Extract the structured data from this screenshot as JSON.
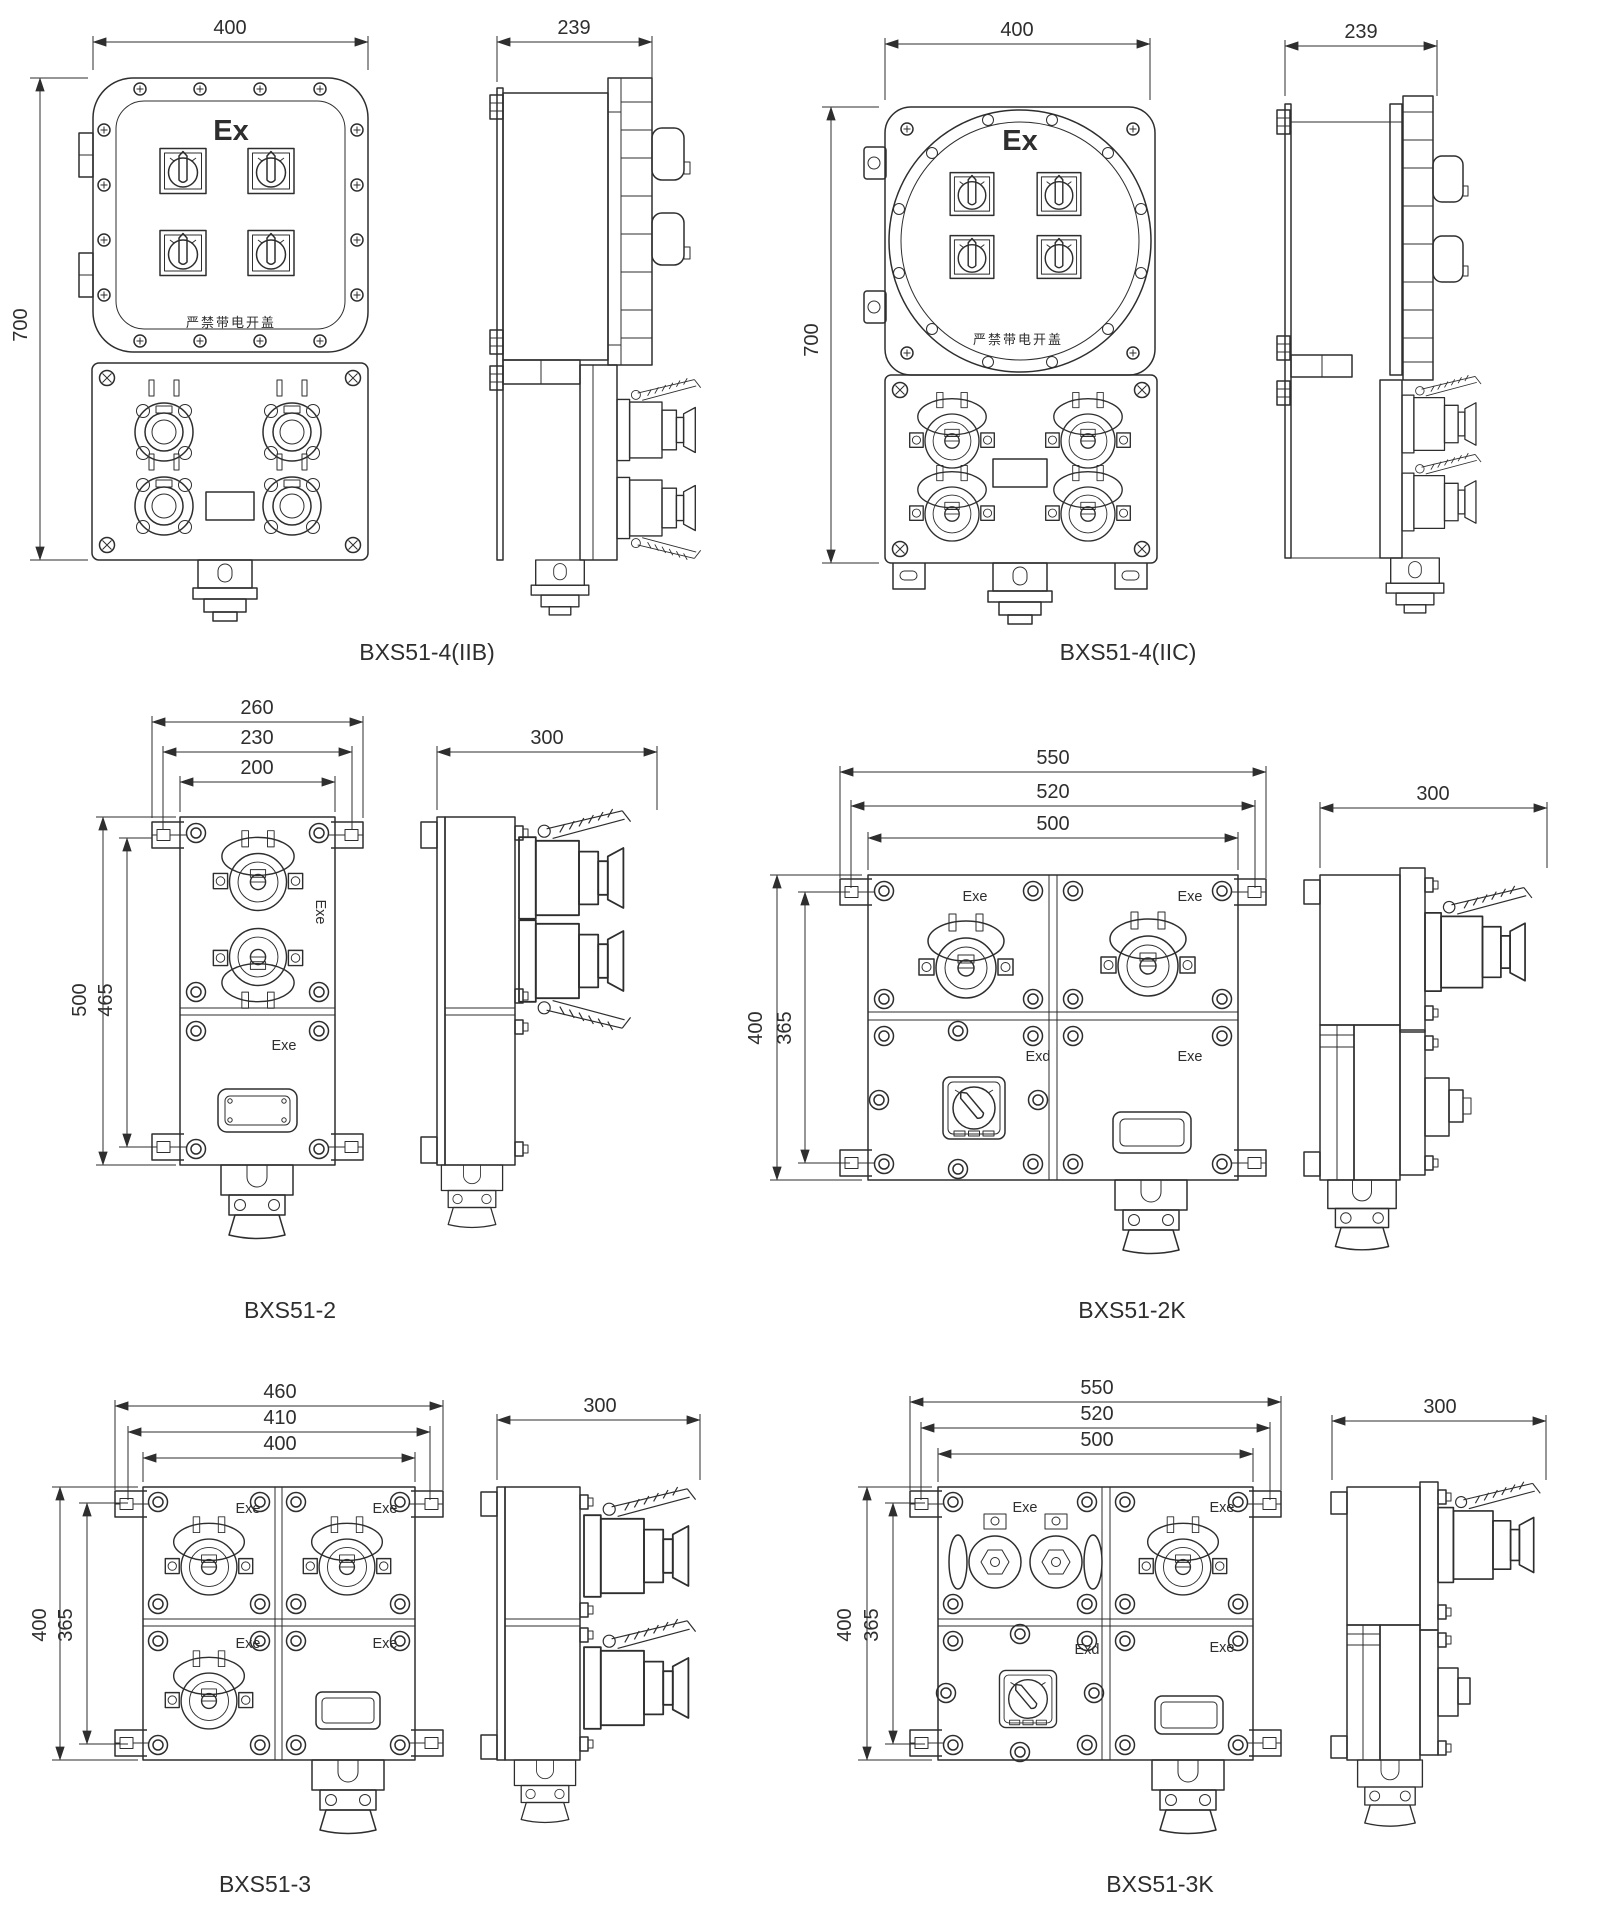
{
  "sheet": {
    "background": "#ffffff",
    "line_color": "#2e2e2e"
  },
  "drawings": {
    "d1": {
      "caption": "BXS51-4(IIB)",
      "ex_mark": "Ex",
      "warning": "严禁带电开盖",
      "dim_width": "400",
      "dim_height": "700",
      "dim_depth": "239"
    },
    "d2": {
      "caption": "BXS51-4(IIC)",
      "ex_mark": "Ex",
      "warning": "严禁带电开盖",
      "dim_width": "400",
      "dim_height": "700",
      "dim_depth": "239"
    },
    "d3": {
      "caption": "BXS51-2",
      "dim_w_outer": "260",
      "dim_w_mid": "230",
      "dim_w_inner": "200",
      "dim_h_outer": "500",
      "dim_h_inner": "465",
      "dim_depth": "300",
      "label_exe": "Exe"
    },
    "d4": {
      "caption": "BXS51-2K",
      "dim_w_outer": "550",
      "dim_w_mid": "520",
      "dim_w_inner": "500",
      "dim_h_outer": "400",
      "dim_h_inner": "365",
      "dim_depth": "300",
      "label_exe": "Exe",
      "label_exd": "Exd"
    },
    "d5": {
      "caption": "BXS51-3",
      "dim_w_outer": "460",
      "dim_w_mid": "410",
      "dim_w_inner": "400",
      "dim_h_outer": "400",
      "dim_h_inner": "365",
      "dim_depth": "300",
      "label_exe": "Exe"
    },
    "d6": {
      "caption": "BXS51-3K",
      "dim_w_outer": "550",
      "dim_w_mid": "520",
      "dim_w_inner": "500",
      "dim_h_outer": "400",
      "dim_h_inner": "365",
      "dim_depth": "300",
      "label_exe": "Exe",
      "label_exd": "Exd"
    }
  }
}
